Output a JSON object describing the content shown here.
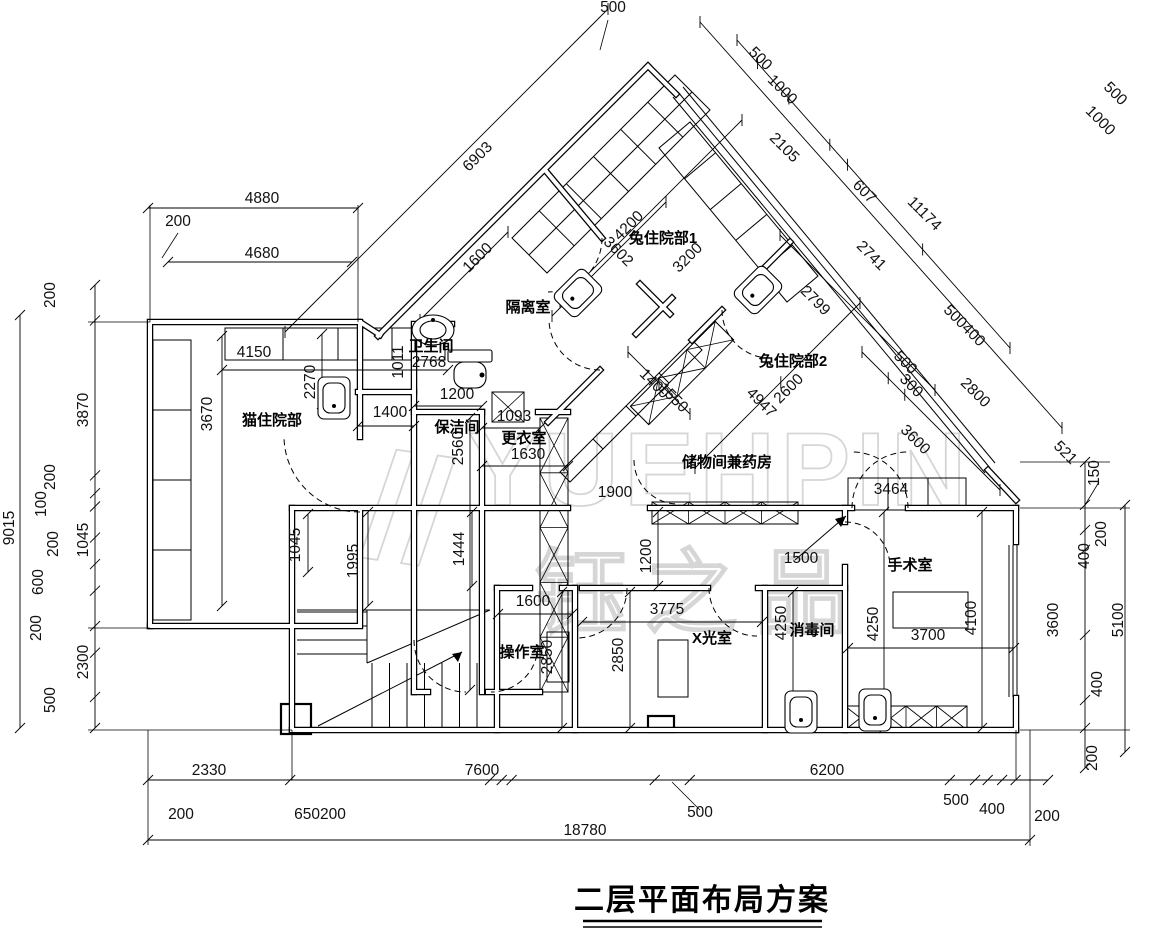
{
  "title": "二层平面布局方案",
  "watermark": {
    "line1": "YUEHPIN",
    "line2": "钰之品"
  },
  "rooms": [
    {
      "t": "猫住院部",
      "x": 272,
      "y": 425,
      "r": 0
    },
    {
      "t": "卫生间",
      "x": 431,
      "y": 351,
      "r": 0
    },
    {
      "t": "隔离室",
      "x": 528,
      "y": 312,
      "r": 0
    },
    {
      "t": "兔住院部1",
      "x": 663,
      "y": 243,
      "r": 0
    },
    {
      "t": "兔住院部2",
      "x": 793,
      "y": 366,
      "r": 0
    },
    {
      "t": "保洁间",
      "x": 457,
      "y": 432,
      "r": 0
    },
    {
      "t": "更衣室",
      "x": 524,
      "y": 443,
      "r": 0
    },
    {
      "t": "储物间兼药房",
      "x": 727,
      "y": 467,
      "r": 0
    },
    {
      "t": "手术室",
      "x": 910,
      "y": 570,
      "r": 0
    },
    {
      "t": "消毒间",
      "x": 812,
      "y": 635,
      "r": 0
    },
    {
      "t": "X光室",
      "x": 712,
      "y": 643,
      "r": 0
    },
    {
      "t": "操作室",
      "x": 522,
      "y": 657,
      "r": 0
    }
  ],
  "dims": [
    {
      "t": "4880",
      "x": 262,
      "y": 203,
      "r": 0
    },
    {
      "t": "200",
      "x": 178,
      "y": 226,
      "r": 0
    },
    {
      "t": "4680",
      "x": 262,
      "y": 258,
      "r": 0
    },
    {
      "t": "200",
      "x": 55,
      "y": 295,
      "r": -90
    },
    {
      "t": "3870",
      "x": 88,
      "y": 410,
      "r": -90
    },
    {
      "t": "9015",
      "x": 14,
      "y": 528,
      "r": -90
    },
    {
      "t": "200",
      "x": 55,
      "y": 477,
      "r": -90
    },
    {
      "t": "100",
      "x": 46,
      "y": 504,
      "r": -90
    },
    {
      "t": "1045",
      "x": 88,
      "y": 540,
      "r": -90
    },
    {
      "t": "200",
      "x": 58,
      "y": 544,
      "r": -90
    },
    {
      "t": "600",
      "x": 43,
      "y": 582,
      "r": -90
    },
    {
      "t": "200",
      "x": 41,
      "y": 628,
      "r": -90
    },
    {
      "t": "2300",
      "x": 88,
      "y": 662,
      "r": -90
    },
    {
      "t": "500",
      "x": 55,
      "y": 700,
      "r": -90
    },
    {
      "t": "2330",
      "x": 209,
      "y": 775,
      "r": 0
    },
    {
      "t": "7600",
      "x": 482,
      "y": 775,
      "r": 0
    },
    {
      "t": "6200",
      "x": 827,
      "y": 775,
      "r": 0
    },
    {
      "t": "200",
      "x": 181,
      "y": 819,
      "r": 0
    },
    {
      "t": "650200",
      "x": 320,
      "y": 819,
      "r": 0
    },
    {
      "t": "500",
      "x": 700,
      "y": 817,
      "r": 0
    },
    {
      "t": "500",
      "x": 956,
      "y": 805,
      "r": 0
    },
    {
      "t": "400",
      "x": 992,
      "y": 814,
      "r": 0
    },
    {
      "t": "200",
      "x": 1047,
      "y": 821,
      "r": 0
    },
    {
      "t": "18780",
      "x": 585,
      "y": 835,
      "r": 0
    },
    {
      "t": "150",
      "x": 1099,
      "y": 473,
      "r": -90
    },
    {
      "t": "200",
      "x": 1106,
      "y": 534,
      "r": -90
    },
    {
      "t": "400",
      "x": 1089,
      "y": 556,
      "r": -90
    },
    {
      "t": "3600",
      "x": 1058,
      "y": 620,
      "r": -90
    },
    {
      "t": "5100",
      "x": 1123,
      "y": 620,
      "r": -90
    },
    {
      "t": "400",
      "x": 1102,
      "y": 684,
      "r": -90
    },
    {
      "t": "200",
      "x": 1097,
      "y": 758,
      "r": -90
    },
    {
      "t": "500",
      "x": 613,
      "y": 12,
      "r": 0
    },
    {
      "t": "6903",
      "x": 481,
      "y": 160,
      "r": -45
    },
    {
      "t": "500",
      "x": 757,
      "y": 62,
      "r": 45
    },
    {
      "t": "1000",
      "x": 779,
      "y": 93,
      "r": 45
    },
    {
      "t": "2105",
      "x": 781,
      "y": 151,
      "r": 45
    },
    {
      "t": "607",
      "x": 861,
      "y": 195,
      "r": 45
    },
    {
      "t": "11174",
      "x": 921,
      "y": 217,
      "r": 45
    },
    {
      "t": "2741",
      "x": 868,
      "y": 259,
      "r": 45
    },
    {
      "t": "500",
      "x": 1112,
      "y": 97,
      "r": 45
    },
    {
      "t": "1000",
      "x": 1097,
      "y": 124,
      "r": 45
    },
    {
      "t": "2799",
      "x": 812,
      "y": 304,
      "r": 45
    },
    {
      "t": "500400",
      "x": 961,
      "y": 329,
      "r": 45
    },
    {
      "t": "500",
      "x": 902,
      "y": 366,
      "r": 45
    },
    {
      "t": "300",
      "x": 908,
      "y": 389,
      "r": 45
    },
    {
      "t": "2800",
      "x": 972,
      "y": 396,
      "r": 45
    },
    {
      "t": "3600",
      "x": 912,
      "y": 443,
      "r": 45
    },
    {
      "t": "521",
      "x": 1062,
      "y": 456,
      "r": 45
    },
    {
      "t": "1600",
      "x": 481,
      "y": 261,
      "r": -45
    },
    {
      "t": "4200",
      "x": 632,
      "y": 229,
      "r": -45
    },
    {
      "t": "3602",
      "x": 615,
      "y": 255,
      "r": 45
    },
    {
      "t": "3200",
      "x": 691,
      "y": 261,
      "r": -45
    },
    {
      "t": "2600",
      "x": 792,
      "y": 392,
      "r": -45
    },
    {
      "t": "4947",
      "x": 758,
      "y": 406,
      "r": 45
    },
    {
      "t": "1400",
      "x": 651,
      "y": 387,
      "r": 45
    },
    {
      "t": "1550",
      "x": 670,
      "y": 401,
      "r": 45
    },
    {
      "t": "1011",
      "x": 403,
      "y": 362,
      "r": -90
    },
    {
      "t": "2768",
      "x": 429,
      "y": 367,
      "r": 0
    },
    {
      "t": "1900",
      "x": 615,
      "y": 497,
      "r": 0
    },
    {
      "t": "4150",
      "x": 254,
      "y": 357,
      "r": 0
    },
    {
      "t": "2270",
      "x": 315,
      "y": 382,
      "r": -90
    },
    {
      "t": "3670",
      "x": 212,
      "y": 414,
      "r": -90
    },
    {
      "t": "1400",
      "x": 390,
      "y": 417,
      "r": 0
    },
    {
      "t": "1200",
      "x": 457,
      "y": 399,
      "r": 0
    },
    {
      "t": "1093",
      "x": 514,
      "y": 421,
      "r": 0
    },
    {
      "t": "2560",
      "x": 463,
      "y": 448,
      "r": -90
    },
    {
      "t": "1630",
      "x": 528,
      "y": 459,
      "r": 0
    },
    {
      "t": "1045",
      "x": 300,
      "y": 545,
      "r": -90
    },
    {
      "t": "1995",
      "x": 358,
      "y": 561,
      "r": -90
    },
    {
      "t": "1444",
      "x": 464,
      "y": 549,
      "r": -90
    },
    {
      "t": "1200",
      "x": 651,
      "y": 556,
      "r": -90
    },
    {
      "t": "1500",
      "x": 801,
      "y": 563,
      "r": 0
    },
    {
      "t": "3464",
      "x": 891,
      "y": 494,
      "r": 0
    },
    {
      "t": "1600",
      "x": 533,
      "y": 606,
      "r": 0
    },
    {
      "t": "3775",
      "x": 667,
      "y": 614,
      "r": 0
    },
    {
      "t": "2850",
      "x": 552,
      "y": 657,
      "r": -90
    },
    {
      "t": "2850",
      "x": 623,
      "y": 655,
      "r": -90
    },
    {
      "t": "4250",
      "x": 786,
      "y": 623,
      "r": -90
    },
    {
      "t": "4250",
      "x": 878,
      "y": 624,
      "r": -90
    },
    {
      "t": "3700",
      "x": 928,
      "y": 640,
      "r": 0
    },
    {
      "t": "4100",
      "x": 976,
      "y": 618,
      "r": -90
    }
  ]
}
